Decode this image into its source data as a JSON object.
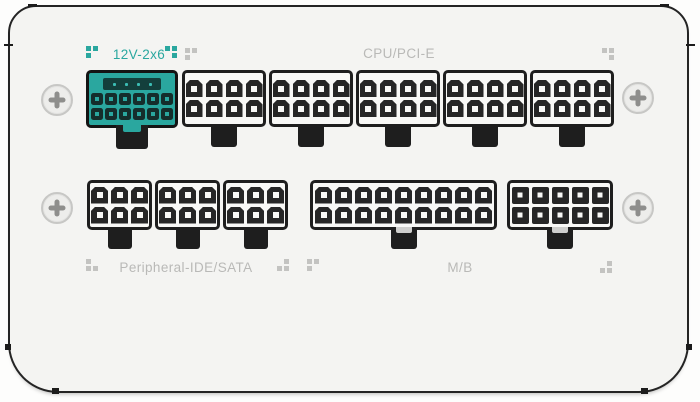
{
  "colors": {
    "accent_teal": "#2aa79f",
    "label_gray": "#b9b9b7",
    "case_background": "#f4f4f2",
    "outline": "#242424",
    "pin_dark": "#262626"
  },
  "labels": {
    "pcie_12v2x6": "12V-2x6",
    "cpu_pcie": "CPU/PCI-E",
    "peripheral": "Peripheral-IDE/SATA",
    "motherboard": "M/B"
  },
  "connectors": {
    "pcie_12v2x6": {
      "name": "12V-2x6 socket",
      "rows": 2,
      "cols": 6,
      "sense_pins": 4
    },
    "cpu_pcie": [
      {
        "name": "CPU/PCI-E 8-pin socket 1",
        "rows": 2,
        "cols": 4
      },
      {
        "name": "CPU/PCI-E 8-pin socket 2",
        "rows": 2,
        "cols": 4
      },
      {
        "name": "CPU/PCI-E 8-pin socket 3",
        "rows": 2,
        "cols": 4
      },
      {
        "name": "CPU/PCI-E 8-pin socket 4",
        "rows": 2,
        "cols": 4
      },
      {
        "name": "CPU/PCI-E 8-pin socket 5",
        "rows": 2,
        "cols": 4
      }
    ],
    "peripheral": [
      {
        "name": "Peripheral-IDE/SATA 6-pin socket 1",
        "rows": 2,
        "cols": 3
      },
      {
        "name": "Peripheral-IDE/SATA 6-pin socket 2",
        "rows": 2,
        "cols": 3
      },
      {
        "name": "Peripheral-IDE/SATA 6-pin socket 3",
        "rows": 2,
        "cols": 3
      }
    ],
    "motherboard": [
      {
        "name": "M/B 18-pin socket",
        "rows": 2,
        "cols": 9
      },
      {
        "name": "M/B 10-pin socket",
        "rows": 2,
        "cols": 5
      }
    ]
  },
  "screws": {
    "icon": "phillips-screw",
    "count": 4
  },
  "deco_dots": [
    {
      "color": "#2aa79f",
      "cells": [
        "tl",
        "tr",
        "bl"
      ]
    },
    {
      "color": "#2aa79f",
      "cells": [
        "tl",
        "tr",
        "br"
      ]
    },
    {
      "color": "#c3c3c1",
      "cells": [
        "tl",
        "tr",
        "bl"
      ]
    },
    {
      "color": "#c3c3c1",
      "cells": [
        "tl",
        "tr",
        "br"
      ]
    },
    {
      "color": "#c3c3c1",
      "cells": [
        "tl",
        "bl",
        "br"
      ]
    },
    {
      "color": "#c3c3c1",
      "cells": [
        "tr",
        "bl",
        "br"
      ]
    },
    {
      "color": "#c3c3c1",
      "cells": [
        "tl",
        "tr",
        "bl"
      ]
    },
    {
      "color": "#c3c3c1",
      "cells": [
        "tr",
        "bl",
        "br"
      ]
    }
  ]
}
